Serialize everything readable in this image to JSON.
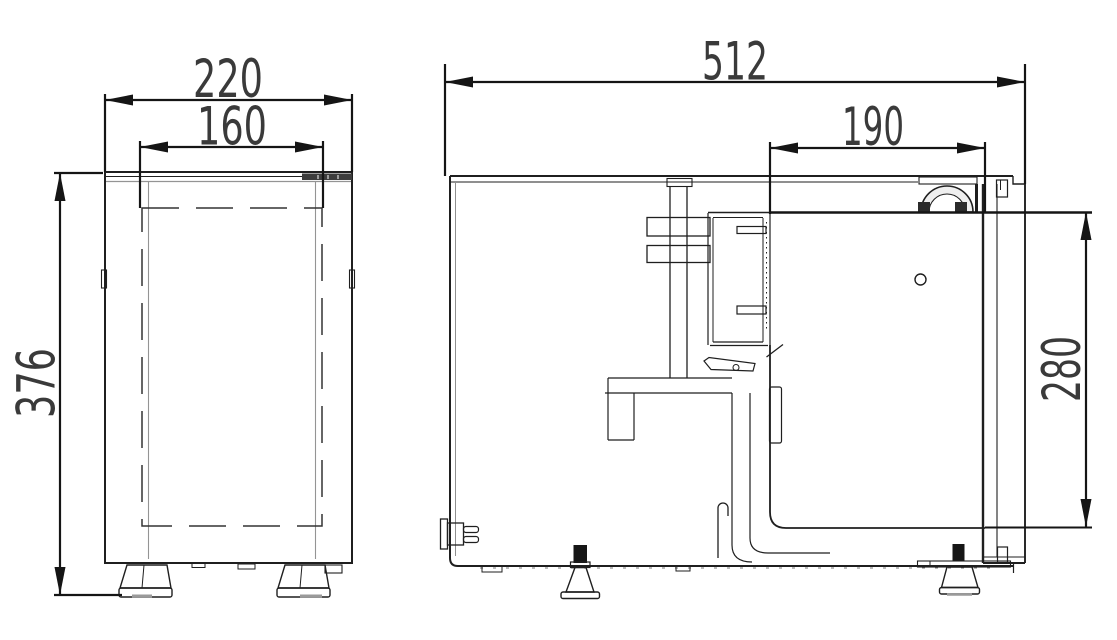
{
  "drawing": {
    "background": "#ffffff",
    "line_color": "#1f1f1f",
    "secondary_line_color": "#949494",
    "dimension_color": "#2d2d2d",
    "dimensions": {
      "front_overall_width": "220",
      "front_inner_width": "160",
      "front_overall_height": "376",
      "side_overall_depth": "512",
      "side_inner_depth": "190",
      "side_inner_height": "280"
    }
  }
}
